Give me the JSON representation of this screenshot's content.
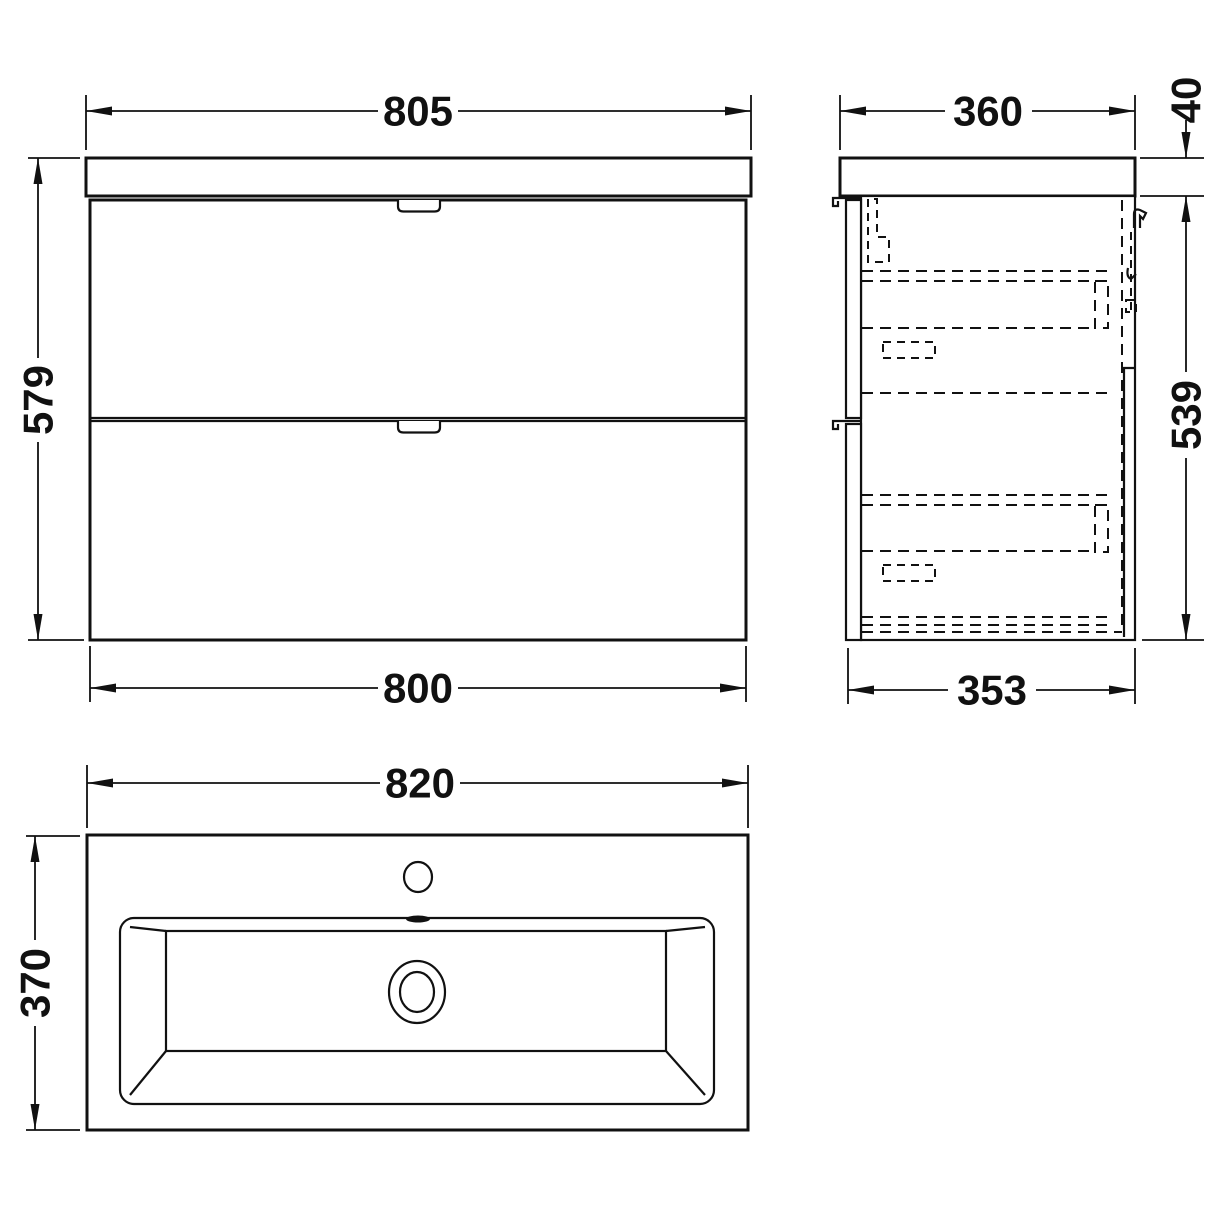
{
  "drawing": {
    "colors": {
      "line": "#111111",
      "background": "#ffffff"
    },
    "views": {
      "front": {
        "dims": {
          "counter_width": "805",
          "overall_height": "579",
          "cabinet_width": "800"
        }
      },
      "side": {
        "dims": {
          "counter_depth": "360",
          "counter_thickness": "40",
          "cabinet_height": "539",
          "cabinet_depth": "353"
        }
      },
      "plan": {
        "dims": {
          "basin_width": "820",
          "basin_depth": "370"
        }
      }
    }
  }
}
